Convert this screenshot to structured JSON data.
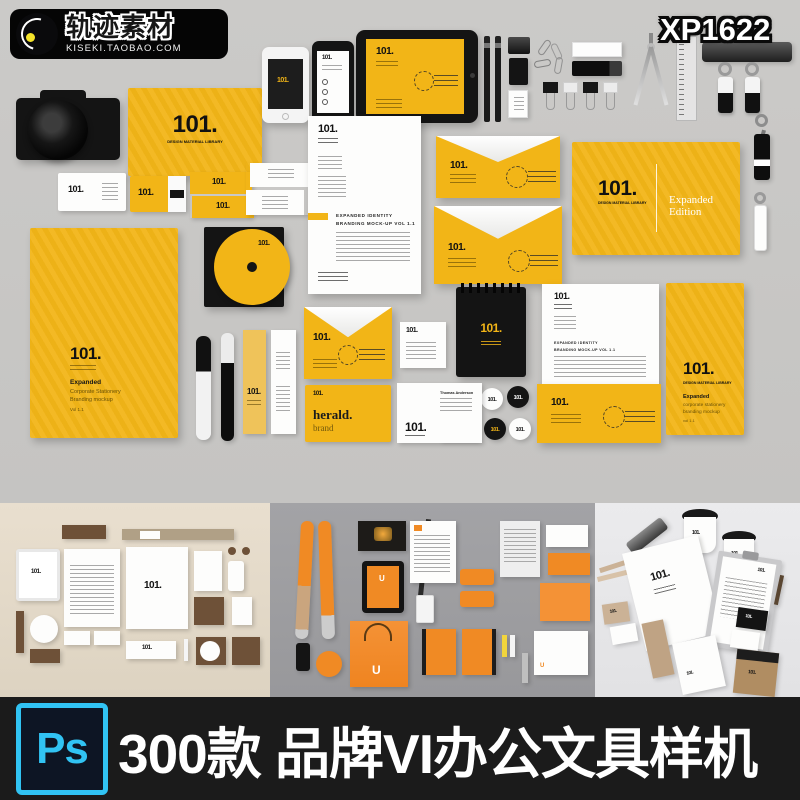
{
  "header": {
    "brand_title": "轨迹素材",
    "brand_sub": "KISEKI.TAOBAO.COM",
    "product_code": "XP1622"
  },
  "brand": {
    "logo": "101.",
    "logo_sub": "DESIGN MATERIAL LIBRARY"
  },
  "hero": {
    "letterhead": {
      "heading1": "EXPANDED IDENTITY",
      "heading2": "BRANDING MOCK-UP VOL 1.1"
    },
    "booklet_edition": "Expanded Edition",
    "folder": {
      "title": "Expanded",
      "line1": "Corporate Stationery",
      "line2": "Branding mockup",
      "line3": "Vol 1.1"
    },
    "book": {
      "title": "Expanded",
      "line1": "corporate stationery",
      "line2": "branding mockup",
      "line3": "vol 1.1"
    },
    "herald": {
      "title": "herald.",
      "sub": "brand"
    },
    "bizcard_name": "Thomas Anderson"
  },
  "previews": {
    "left_logo": "101.",
    "middle_logo": "U",
    "right_logo": "101."
  },
  "banner": {
    "ps_label": "Ps",
    "title": "300款 品牌VI办公文具样机"
  },
  "colors": {
    "yellow": "#f2b517",
    "hero_bg": "#c8c7c5",
    "banner_bg": "#1b1b1b",
    "ps_cyan": "#31c3f3"
  }
}
